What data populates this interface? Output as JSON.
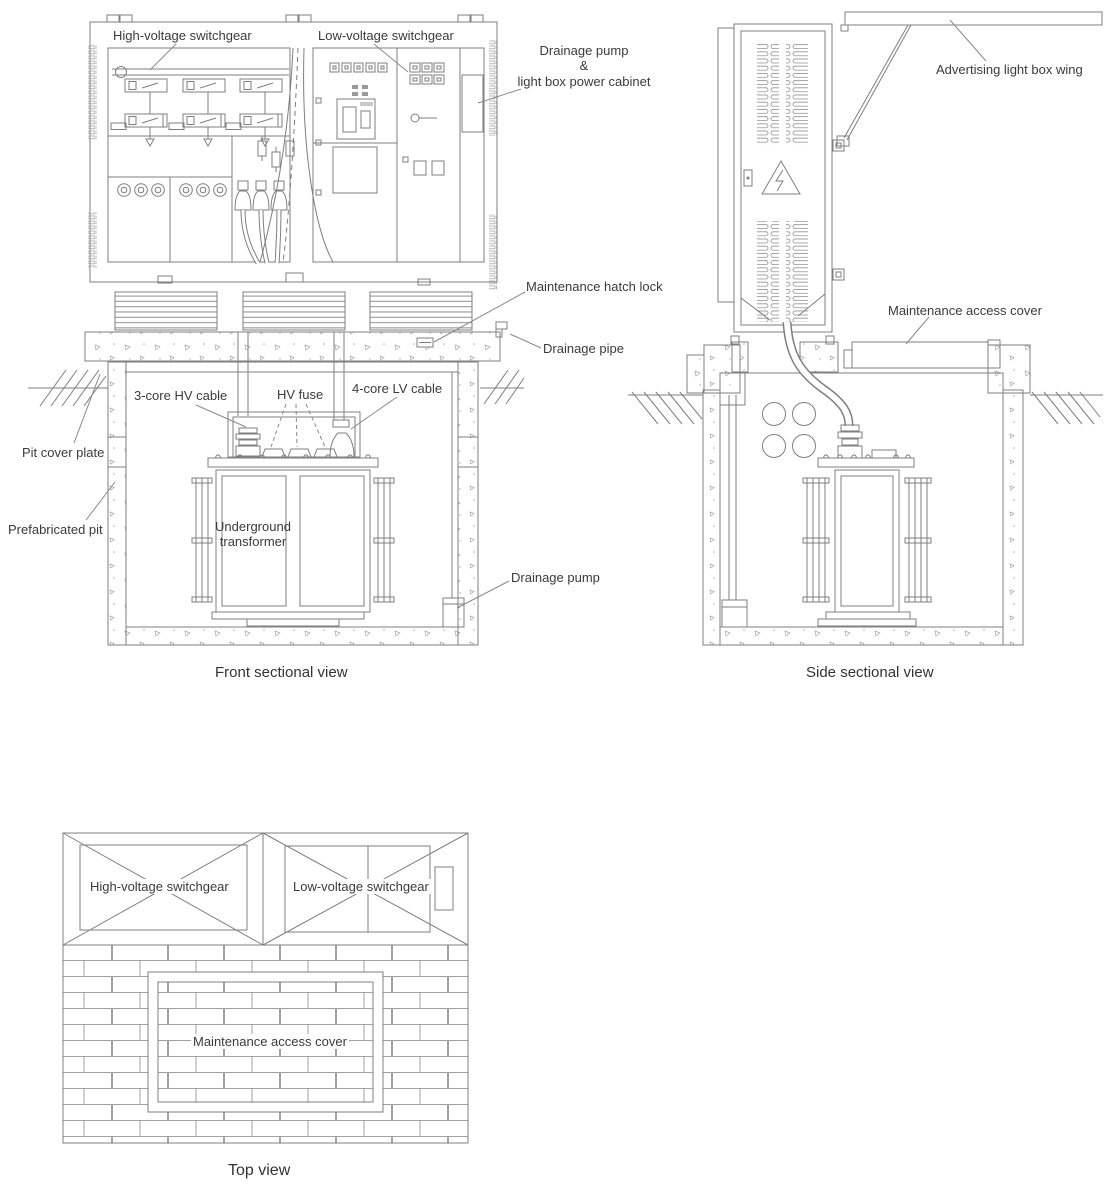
{
  "front_view": {
    "caption": "Front sectional view",
    "labels": {
      "hv_switchgear": "High-voltage switchgear",
      "lv_switchgear": "Low-voltage switchgear",
      "pump_lightbox_cabinet": "Drainage pump\n&\nlight box power cabinet",
      "maintenance_hatch_lock": "Maintenance hatch lock",
      "drainage_pipe": "Drainage pipe",
      "hv_cable": "3-core HV cable",
      "hv_fuse": "HV fuse",
      "lv_cable": "4-core LV cable",
      "pit_cover_plate": "Pit cover plate",
      "prefabricated_pit": "Prefabricated pit",
      "underground_transformer": "Underground transformer",
      "drainage_pump": "Drainage pump"
    }
  },
  "side_view": {
    "caption": "Side sectional view",
    "labels": {
      "advertising_wing": "Advertising light box wing",
      "maintenance_access_cover": "Maintenance access cover"
    }
  },
  "top_view": {
    "caption": "Top view",
    "labels": {
      "hv_switchgear": "High-voltage switchgear",
      "lv_switchgear": "Low-voltage switchgear",
      "maintenance_access_cover": "Maintenance access cover"
    }
  },
  "colors": {
    "line": "#7f7f7f",
    "text": "#3b3b3b"
  }
}
